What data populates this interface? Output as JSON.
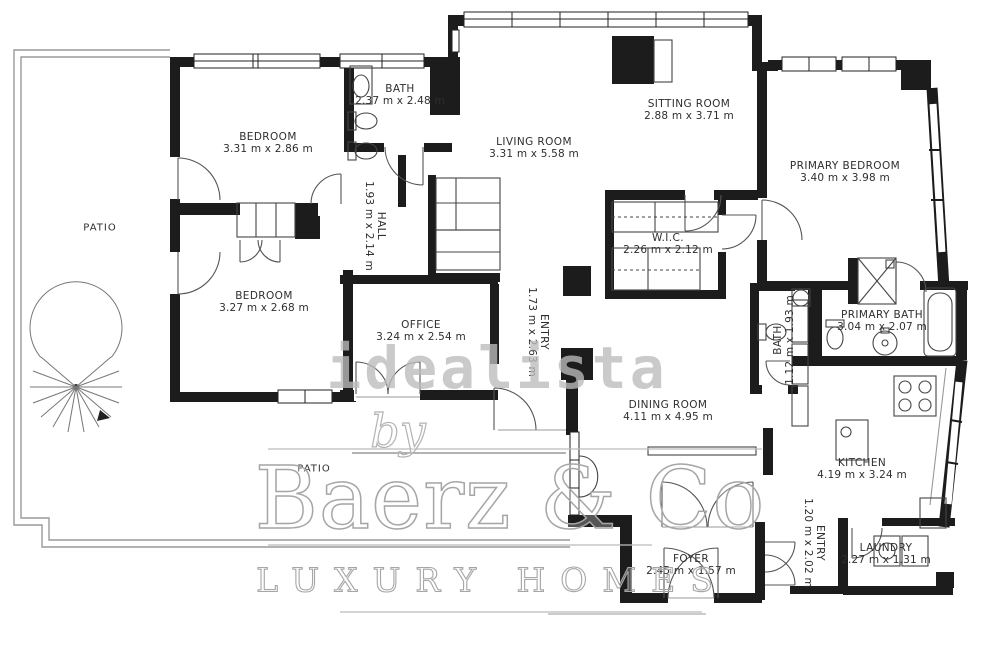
{
  "watermark": {
    "portal": "idealista",
    "brand_prefix": "by",
    "brand": "Baerz & Co",
    "tagline": "LUXURY HOMES"
  },
  "rooms": [
    {
      "name": "PATIO",
      "dims": ""
    },
    {
      "name": "BEDROOM",
      "dims": "3.31 m x 2.86 m"
    },
    {
      "name": "BATH",
      "dims": "2.37 m x 2.48 m"
    },
    {
      "name": "LIVING ROOM",
      "dims": "3.31 m x 5.58 m"
    },
    {
      "name": "SITTING ROOM",
      "dims": "2.88 m x 3.71 m"
    },
    {
      "name": "PRIMARY BEDROOM",
      "dims": "3.40 m x 3.98 m"
    },
    {
      "name": "HALL",
      "dims": "1.93 m x 2.14 m"
    },
    {
      "name": "W.I.C.",
      "dims": "2.26 m x 2.12 m"
    },
    {
      "name": "BEDROOM",
      "dims": "3.27 m x 2.68 m"
    },
    {
      "name": "OFFICE",
      "dims": "3.24 m x 2.54 m"
    },
    {
      "name": "ENTRY",
      "dims": "1.73 m x 2.63 m"
    },
    {
      "name": "BATH",
      "dims": "1.12 m x 1.93 m"
    },
    {
      "name": "PRIMARY BATH",
      "dims": "3.04 m x 2.07 m"
    },
    {
      "name": "DINING ROOM",
      "dims": "4.11 m x 4.95 m"
    },
    {
      "name": "KITCHEN",
      "dims": "4.19 m x 3.24 m"
    },
    {
      "name": "PATIO",
      "dims": ""
    },
    {
      "name": "FOYER",
      "dims": "2.45 m x 1.57 m"
    },
    {
      "name": "ENTRY",
      "dims": "1.20 m x 2.02 m"
    },
    {
      "name": "LAUNDRY",
      "dims": "2.27 m x 1.31 m"
    }
  ],
  "colors": {
    "wall": "#1c1c1c",
    "patio_line": "#9a9a9a",
    "door": "#555555",
    "watermark": "#bbbbbb"
  }
}
